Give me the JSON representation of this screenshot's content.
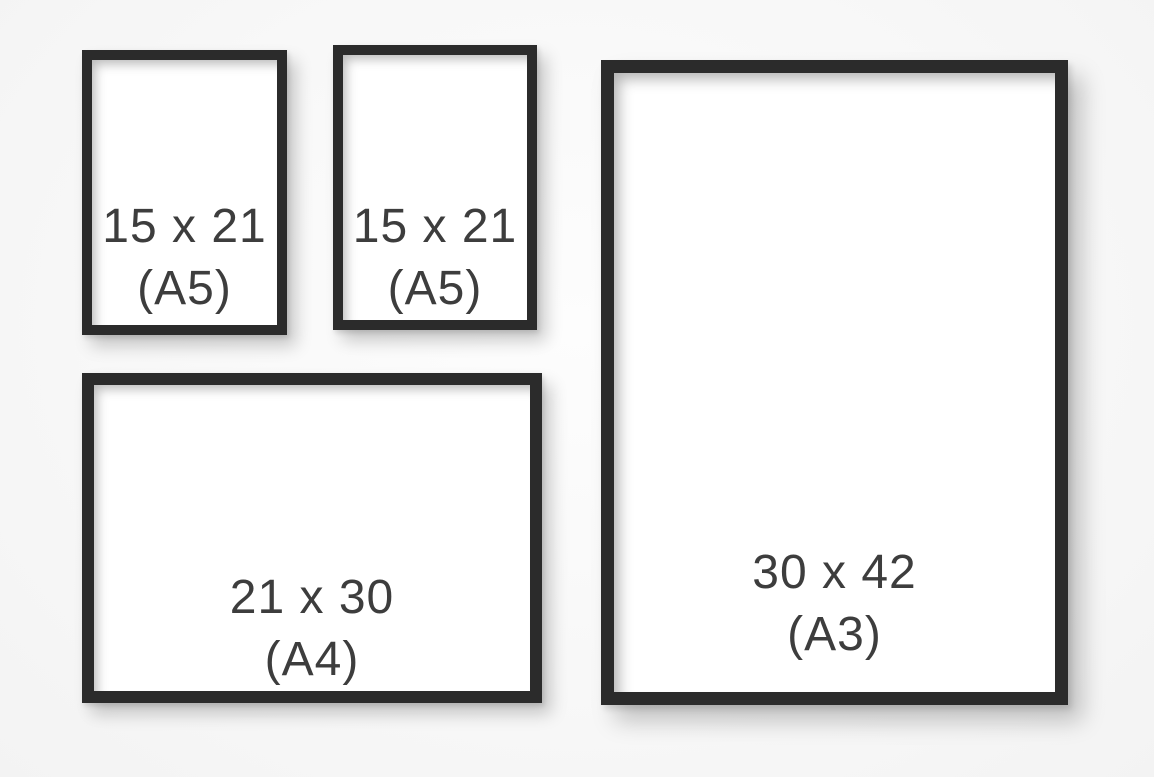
{
  "title": "Picture frame size comparison",
  "colors": {
    "frame_border": "#2b2b2b",
    "paper": "#ffffff",
    "label_text": "#3d3d3d",
    "background": "#f8f8f8",
    "shadow": "rgba(0,0,0,0.2)"
  },
  "frames": [
    {
      "id": "a5-left",
      "orientation": "portrait",
      "size_label": "15 x 21",
      "format_label": "(A5)",
      "format": "A5",
      "dimensions_cm": "15 x 21"
    },
    {
      "id": "a5-center",
      "orientation": "portrait",
      "size_label": "15 x 21",
      "format_label": "(A5)",
      "format": "A5",
      "dimensions_cm": "15 x 21"
    },
    {
      "id": "a4",
      "orientation": "landscape",
      "size_label": "21 x 30",
      "format_label": "(A4)",
      "format": "A4",
      "dimensions_cm": "21 x 30"
    },
    {
      "id": "a3",
      "orientation": "portrait",
      "size_label": "30 x 42",
      "format_label": "(A3)",
      "format": "A3",
      "dimensions_cm": "30 x 42"
    }
  ]
}
